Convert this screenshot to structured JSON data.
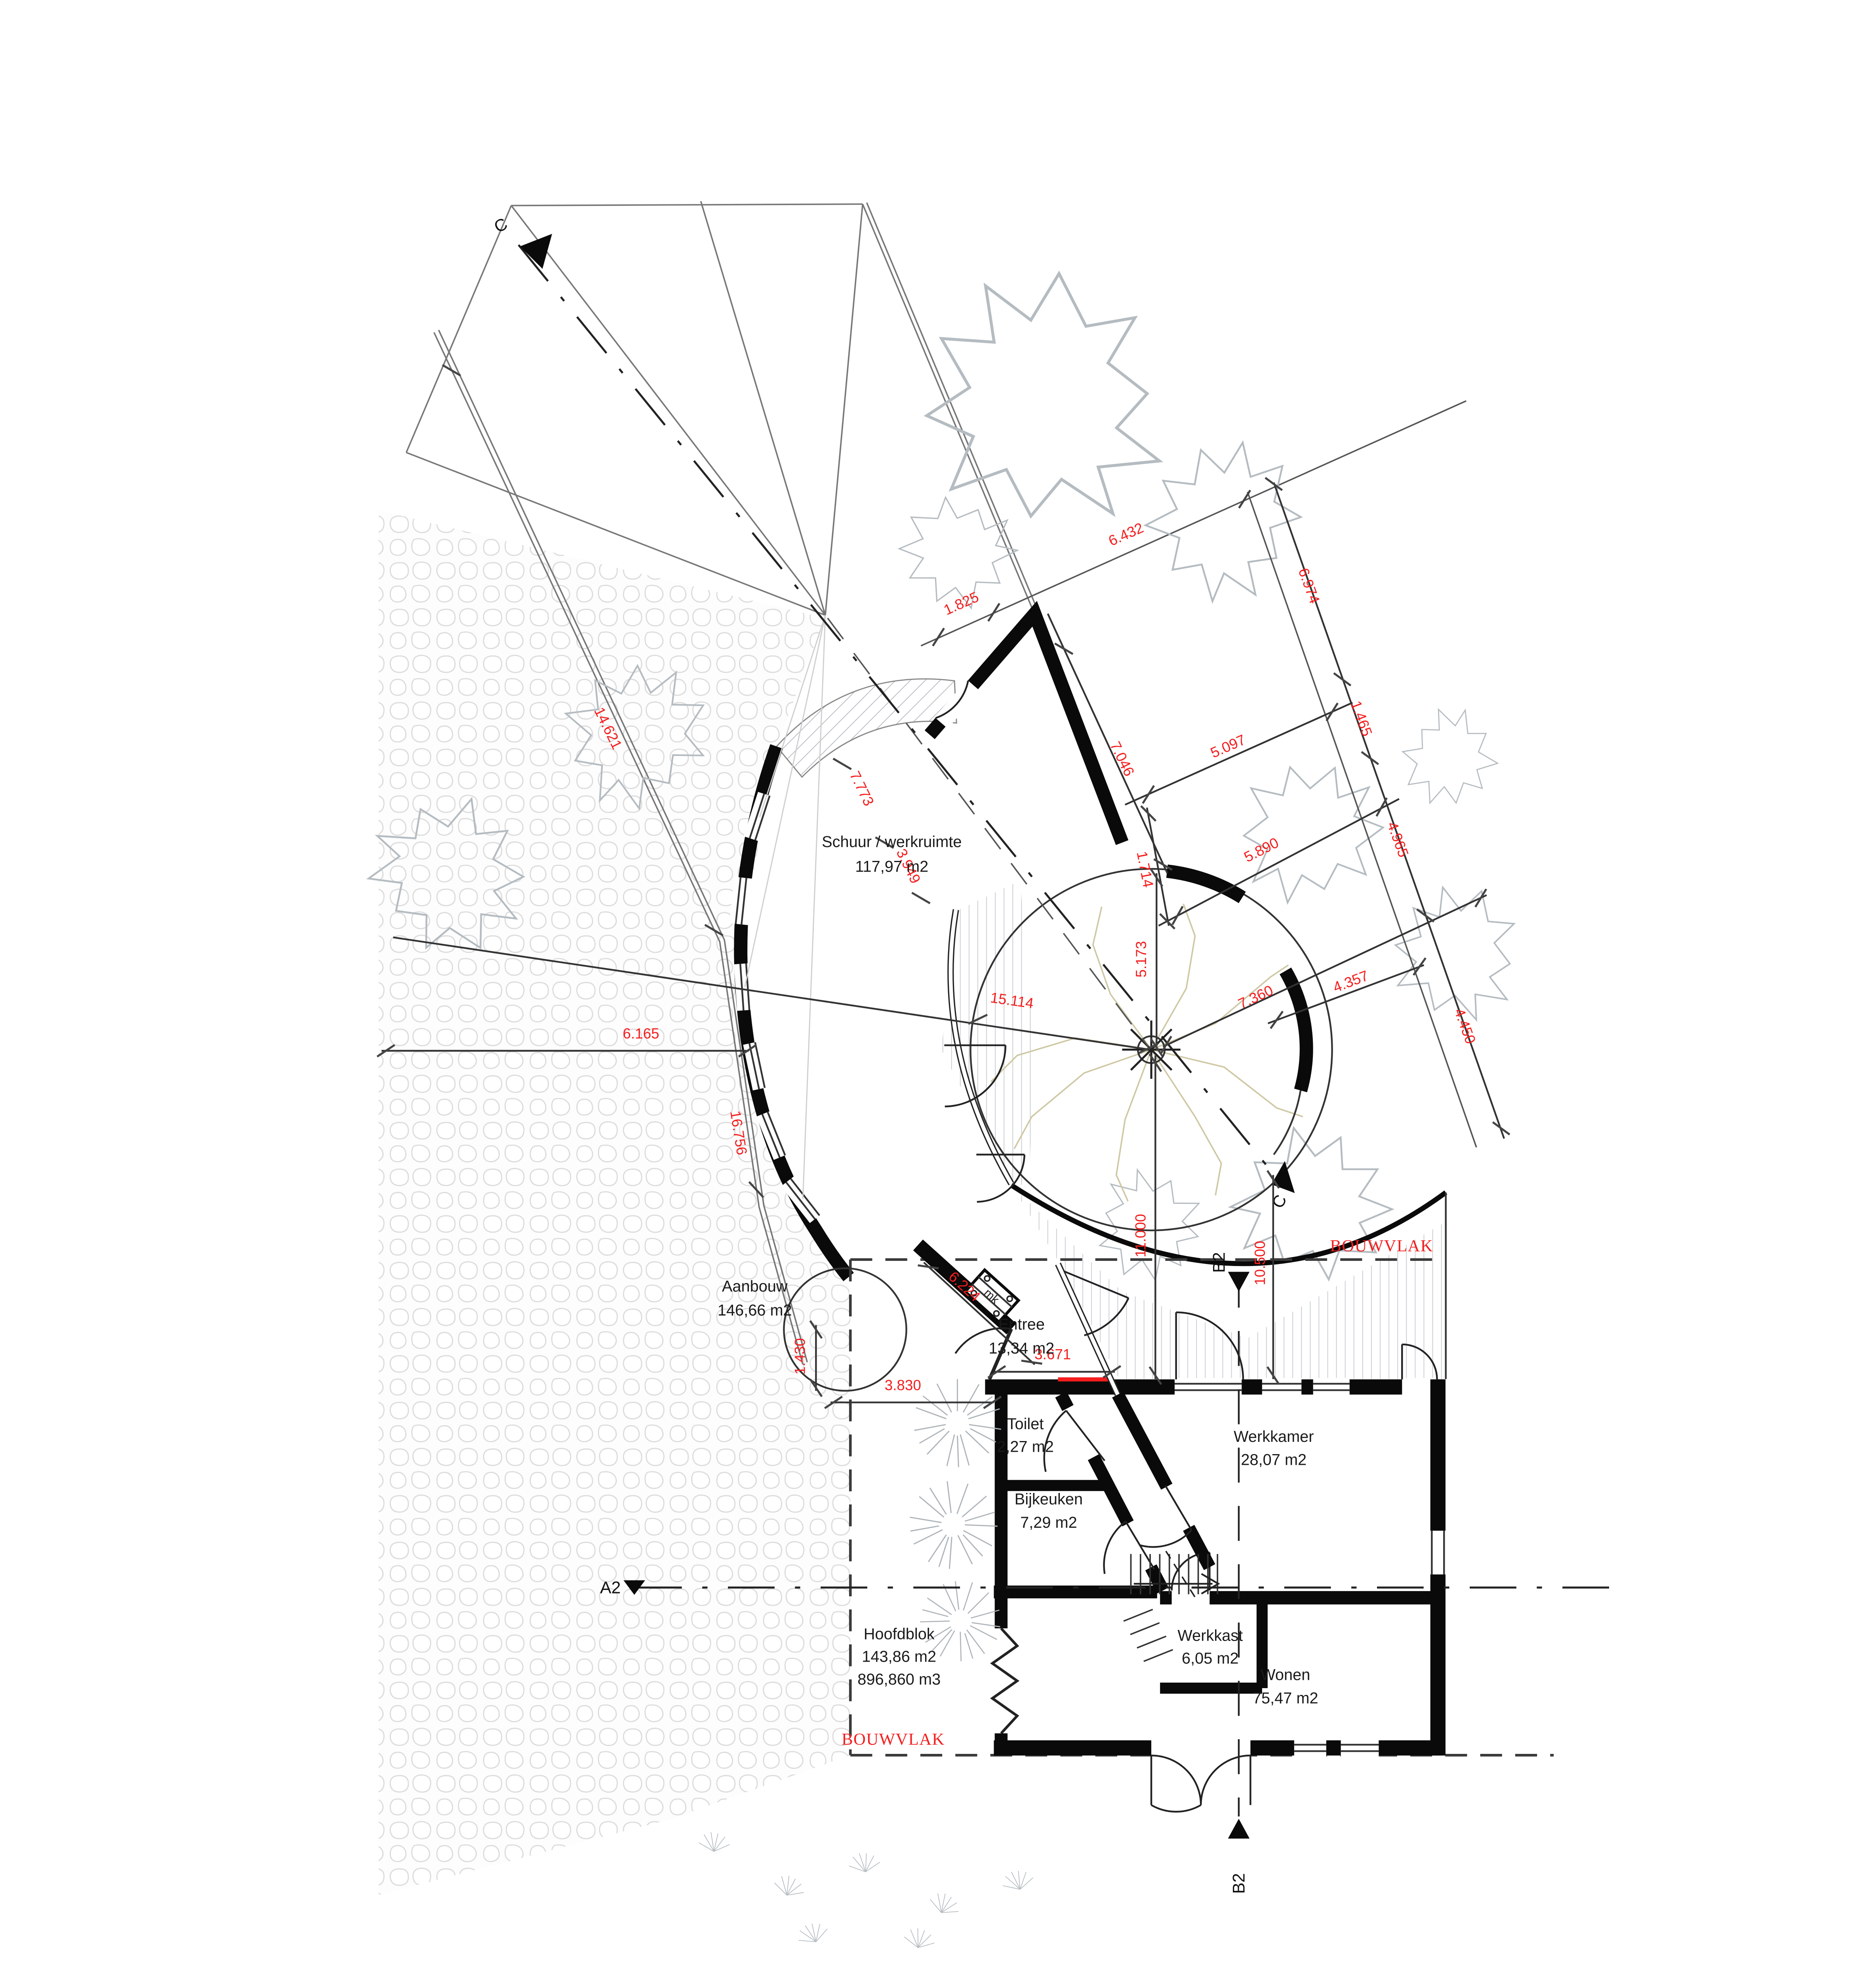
{
  "drawing": {
    "type": "architectural-site-floor-plan",
    "rooms": {
      "schuur": {
        "name": "Schuur / werkruimte",
        "area": "117,97 m2"
      },
      "aanbouw": {
        "name": "Aanbouw",
        "area": "146,66 m2"
      },
      "entree": {
        "name": "Entree",
        "area": "13,34 m2"
      },
      "toilet": {
        "name": "Toilet",
        "area": "2,27 m2"
      },
      "bijkeuken": {
        "name": "Bijkeuken",
        "area": "7,29 m2"
      },
      "werkkamer": {
        "name": "Werkkamer",
        "area": "28,07 m2"
      },
      "werkkast": {
        "name": "Werkkast",
        "area": "6,05 m2"
      },
      "wonen": {
        "name": "Wonen",
        "area": "75,47 m2"
      },
      "hoofdblok": {
        "name": "Hoofdblok",
        "area": "143,86 m2",
        "volume": "896,860 m3"
      },
      "meterkast": {
        "label": "mk"
      }
    },
    "dimensions": {
      "d1825": "1.825",
      "d6432": "6.432",
      "d7046": "7.046",
      "d6974": "6.974",
      "d1465": "1.465",
      "d5097": "5.097",
      "d5890": "5.890",
      "d1714": "1.714",
      "d4965": "4.965",
      "d4450": "4.450",
      "d4357": "4.357",
      "d5173": "5.173",
      "d7360": "7.360",
      "d15114": "15.114",
      "d6165": "6.165",
      "d16756": "16.756",
      "d11000": "11.000",
      "d10500": "10.500",
      "d14621": "14.621",
      "d7773": "7.773",
      "d3949": "3.949",
      "d6224": "6.224",
      "d1430": "1.430",
      "d3671": "3.671",
      "d3830": "3.830"
    },
    "markers": {
      "section_a": "A2",
      "section_b": "B2",
      "section_c": "C"
    },
    "zone_label": "BOUWVLAK",
    "colors": {
      "dimension_red": "#f51d1d",
      "wall_black": "#0a0a0a",
      "hatch_gray": "#c9ced2",
      "canopy_gray": "#b5bcc1",
      "tree_beige": "#cfc8a4",
      "paving_gray": "#dcdcdc"
    }
  }
}
